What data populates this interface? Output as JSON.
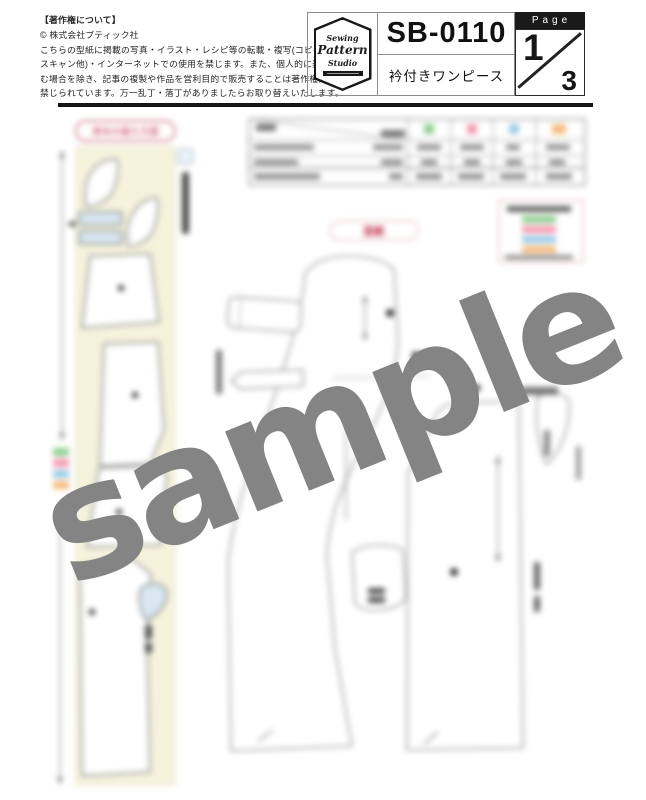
{
  "header": {
    "copyright": {
      "title": "【著作権について】",
      "company": "© 株式会社ブティック社",
      "lines": [
        "こちらの型紙に掲載の写真・イラスト・レシピ等の転載・複写(コピー・",
        "スキャン他)・インターネットでの使用を禁じます。また、個人的に楽し",
        "む場合を除き、記事の複製や作品を営利目的で販売することは著作権法で",
        "禁じられています。万一乱丁・落丁がありましたらお取り替えいたします。"
      ]
    },
    "logo": {
      "word1": "Sewing",
      "word2": "Pattern",
      "word3": "Studio"
    },
    "pattern_number": "SB-0110",
    "pattern_name": "衿付きワンピース",
    "page": {
      "label": "Page",
      "current": "1",
      "total": "3"
    }
  },
  "content": {
    "cutting_layout_label": "表布の裁ち方図",
    "pattern_label": "型紙",
    "watermark": "sample",
    "legend_colors": [
      "#8fcf8f",
      "#f59ab0",
      "#9ccbe8",
      "#f5bc80"
    ],
    "colors": {
      "accent_red": "#c03048",
      "fabric_cream": "#f5f3dc",
      "interfacing_blue": "#d9e7f2",
      "watermark_gray": "#848484",
      "rule_black": "#141414"
    }
  }
}
